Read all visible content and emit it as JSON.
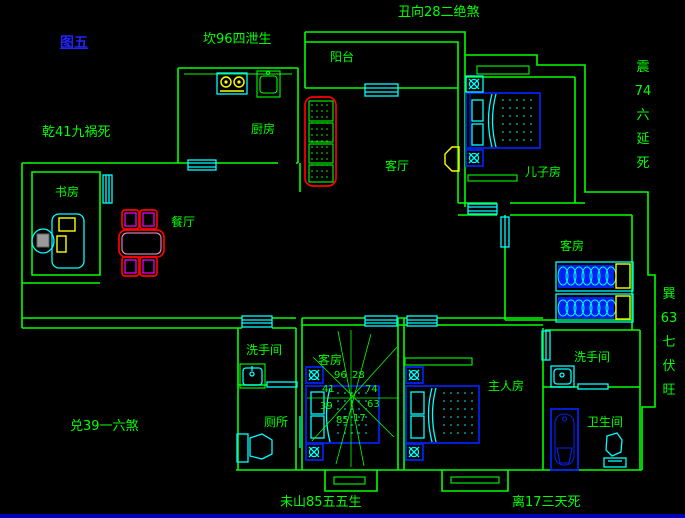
{
  "colors": {
    "wall": "#00ff00",
    "glass": "#00ffff",
    "bed": "#0022ee",
    "figure_blue": "#2222ff",
    "accent_red": "#ff0000",
    "accent_magenta": "#ff00ff",
    "accent_yellow": "#ffff00",
    "border_blue": "#0000bb"
  },
  "figure_label": "图五",
  "annotations": {
    "top": "丑向28二绝煞",
    "north": "坎96四泄生",
    "northwest": "乾41九祸死",
    "west": "兑39一六煞",
    "east_vertical": [
      "震",
      "74",
      "六",
      "延",
      "死"
    ],
    "southeast_vertical": [
      "巽",
      "63",
      "七",
      "伏",
      "旺"
    ],
    "south_left": "未山85五五生",
    "south_right": "离17三天死"
  },
  "rooms": {
    "balcony": "阳台",
    "kitchen": "厨房",
    "living": "客厅",
    "son": "儿子房",
    "study": "书房",
    "dining": "餐厅",
    "guest_right": "客房",
    "guest_middle": "客房",
    "washroom_left": "洗手间",
    "washroom_right": "洗手间",
    "toilet": "厕所",
    "master": "主人房",
    "bathroom": "卫生间"
  },
  "compass": {
    "numbers": [
      "96",
      "28",
      "41",
      "74",
      "39",
      "63",
      "85",
      "17"
    ]
  }
}
